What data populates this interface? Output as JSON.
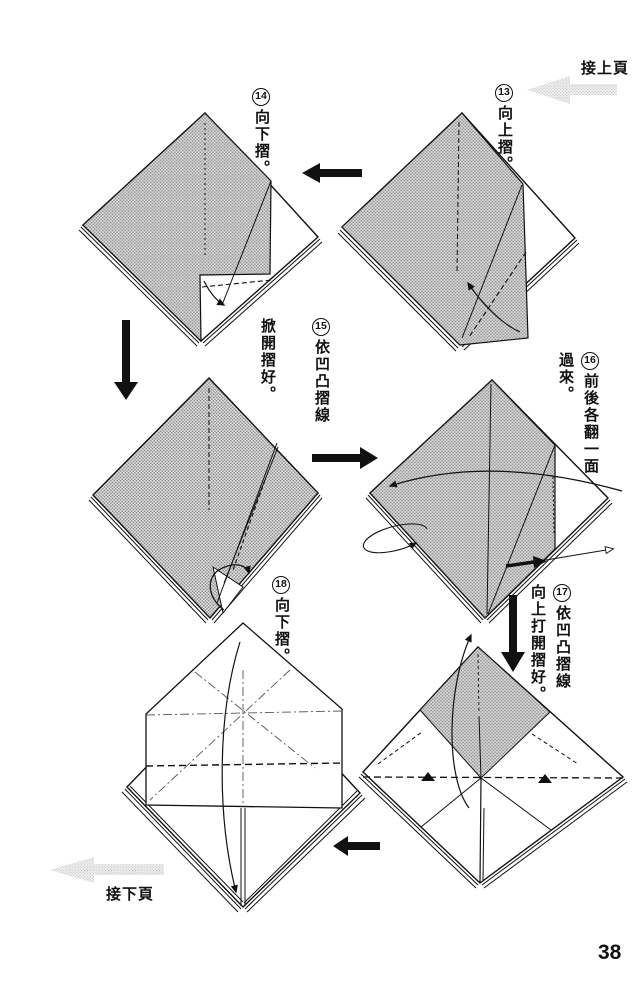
{
  "page": {
    "number": "38",
    "continue_from_prev": "接上頁",
    "continue_to_next": "接下頁"
  },
  "colors": {
    "paper_shading": "#bfbfbf",
    "line": "#111111",
    "nav_arrow": "#d9d9d9"
  },
  "icons": {
    "prev_page_arrow": "halftone-left-arrow",
    "next_page_arrow": "halftone-left-arrow",
    "step_flow_arrow": "solid-black-arrow"
  },
  "steps": [
    {
      "num": "13",
      "lines": [
        "向上摺。"
      ]
    },
    {
      "num": "14",
      "lines": [
        "向下摺。"
      ]
    },
    {
      "num": "15",
      "lines": [
        "依凹凸摺線",
        "掀開摺好。"
      ]
    },
    {
      "num": "16",
      "lines": [
        "前後各翻一面",
        "過來。"
      ]
    },
    {
      "num": "17",
      "lines": [
        "依凹凸摺線",
        "向上打開摺好。"
      ]
    },
    {
      "num": "18",
      "lines": [
        "向下摺。"
      ]
    }
  ]
}
